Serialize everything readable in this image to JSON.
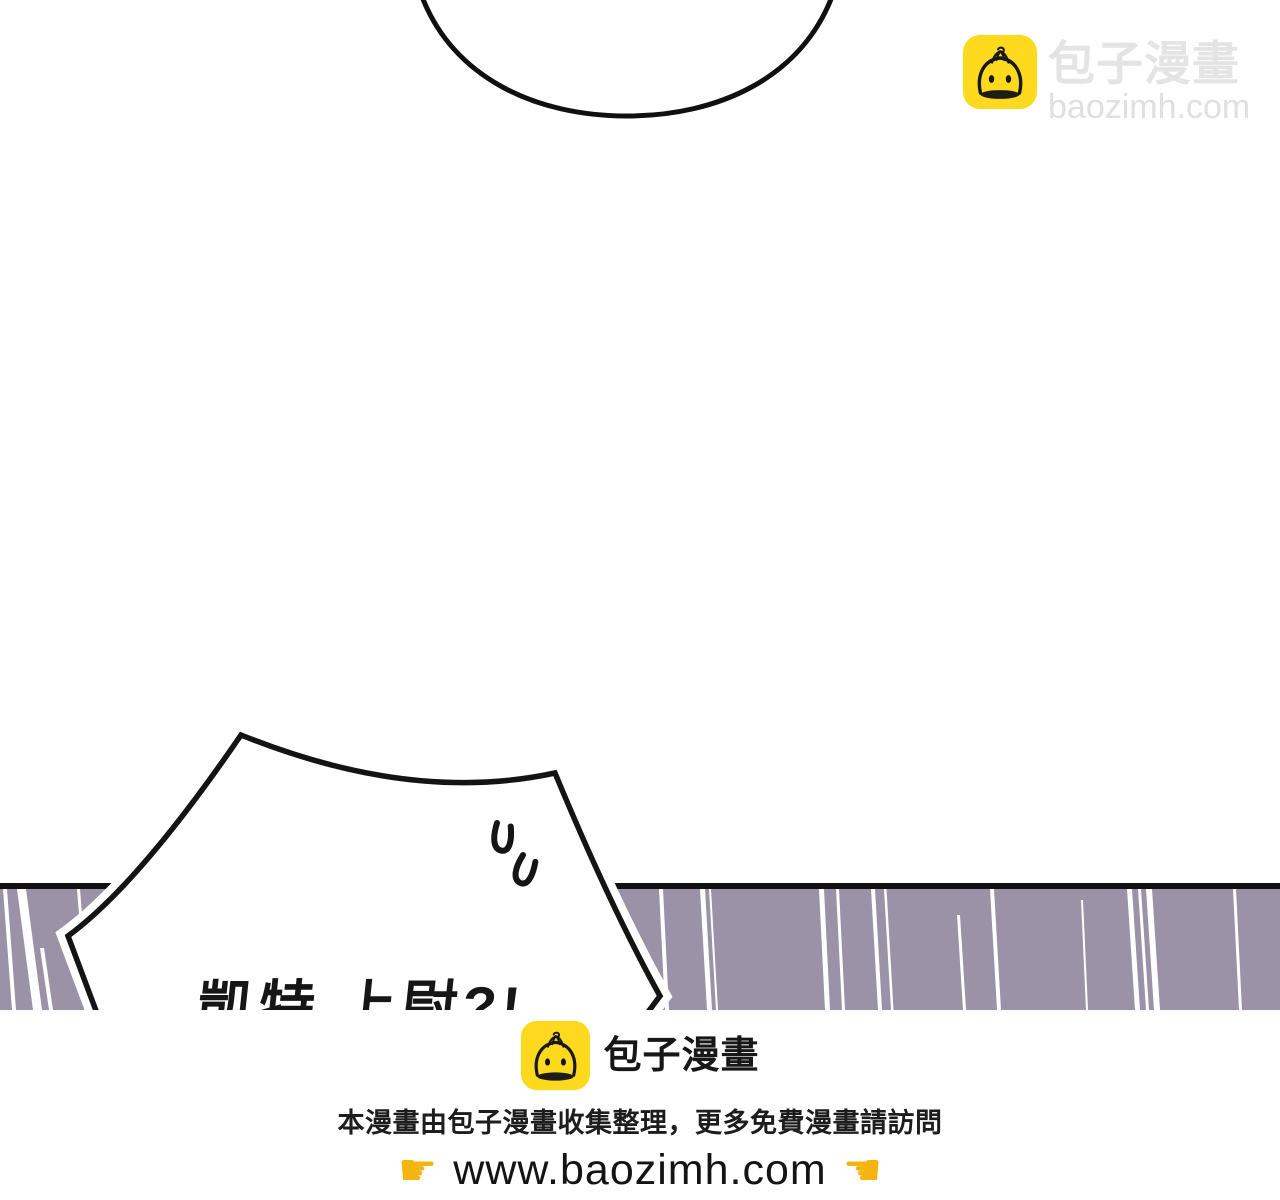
{
  "site": {
    "brand_name": "包子漫畫",
    "domain": "baozimh.com"
  },
  "colors": {
    "accent_yellow": "#ffd91e",
    "band_purple": "#9b92a7",
    "band_border": "#111111",
    "ink_black": "#161616",
    "watermark_gray": "#e4e4e4",
    "watermark_gray2": "#e0e0e0",
    "hand_yellow": "#f6b40e",
    "speed_line_white": "#ffffff"
  },
  "watermark": {
    "icon": "baozi-bun-icon",
    "brand": "包子漫畫",
    "domain": "baozimh.com"
  },
  "comic": {
    "speech_bubble": {
      "text": "凱特 上尉?!"
    }
  },
  "footer": {
    "icon": "baozi-bun-icon",
    "brand": "包子漫畫",
    "notice": "本漫畫由包子漫畫收集整理，更多免費漫畫請訪問",
    "url": "www.baozimh.com",
    "hand_before_glyph": "☛",
    "hand_after_glyph": "☚"
  },
  "decorations": {
    "speed_lines": [
      {
        "x": 3,
        "w": 4,
        "dx": 9
      },
      {
        "x": 17,
        "w": 9,
        "dx": 16
      },
      {
        "x": 40,
        "w": 4,
        "dx": 9,
        "y1": 948
      },
      {
        "x": 77,
        "w": 3,
        "dx": 6,
        "y2": 965
      },
      {
        "x": 659,
        "w": 4,
        "dx": 6
      },
      {
        "x": 700,
        "w": 5,
        "dx": 7
      },
      {
        "x": 709,
        "w": 2,
        "dx": 7
      },
      {
        "x": 819,
        "w": 5,
        "dx": 6
      },
      {
        "x": 836,
        "w": 3,
        "dx": 6
      },
      {
        "x": 871,
        "w": 4,
        "dx": 7
      },
      {
        "x": 884,
        "w": 2.5,
        "dx": 7
      },
      {
        "x": 957,
        "w": 3,
        "dx": 6,
        "y1": 915
      },
      {
        "x": 990,
        "w": 4,
        "dx": 7
      },
      {
        "x": 1081,
        "w": 2,
        "dx": 5,
        "y1": 900
      },
      {
        "x": 1127,
        "w": 5,
        "dx": 8
      },
      {
        "x": 1138,
        "w": 3,
        "dx": 8
      },
      {
        "x": 1146,
        "w": 6,
        "dx": 8
      },
      {
        "x": 1233,
        "w": 3,
        "dx": 6
      }
    ]
  }
}
